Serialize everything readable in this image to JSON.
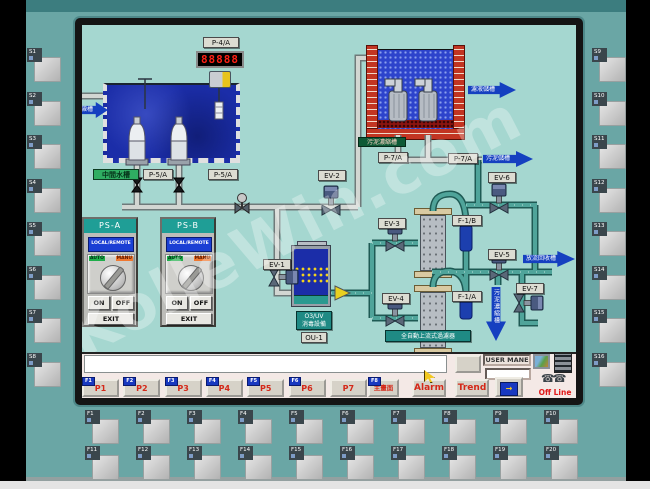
{
  "device": {
    "side_keys_left": [
      "S1",
      "S2",
      "S3",
      "S4",
      "S5",
      "S6",
      "S7",
      "S8"
    ],
    "side_keys_right": [
      "S9",
      "S10",
      "S11",
      "S12",
      "S13",
      "S14",
      "S15",
      "S16"
    ],
    "fn_keys_row1": [
      "F1",
      "F2",
      "F3",
      "F4",
      "F5",
      "F6",
      "F7",
      "F8",
      "F9",
      "F10"
    ],
    "fn_keys_row2": [
      "F11",
      "F12",
      "F13",
      "F14",
      "F15",
      "F16",
      "F17",
      "F18",
      "F19",
      "F20"
    ]
  },
  "watermark": "KolleWin.com",
  "screen": {
    "mimic": {
      "p4a": "P-4/A",
      "flow_display": "88888",
      "mid_tank": "中間水槽",
      "p5a": "P-5/A",
      "p5b": "P-5/A",
      "inlet_arrow": "沉澱槽",
      "filtrate_arrow": "濾液儲槽",
      "sludge_thickener": "污泥濃縮槽",
      "p7a": "P-7/A",
      "p7b": "P-7/A",
      "sludge_arrow": "污泥儲槽",
      "ev1": "EV-1",
      "ev2": "EV-2",
      "ev3": "EV-3",
      "ev4": "EV-4",
      "ev5": "EV-5",
      "ev6": "EV-6",
      "ev7": "EV-7",
      "f1a": "F-1/A",
      "f1b": "F-1/B",
      "discharge_arrow": "放流回收槽",
      "thickener_arrow": "污泥濃縮槽",
      "filter_unit": "全自動上流式過濾器",
      "ou1_line1": "O3/UV",
      "ou1_line2": "消毒設備",
      "ou1": "OU-1"
    },
    "panels": {
      "a": {
        "title": "PS-A"
      },
      "b": {
        "title": "PS-B"
      },
      "local_remote": "LOCAL/REMOTE",
      "auto": "AUTO",
      "manu": "MANU",
      "on": "ON",
      "off": "OFF",
      "exit": "EXIT"
    },
    "toolbar": {
      "page_buttons": [
        {
          "tag": "F1",
          "label": "P1"
        },
        {
          "tag": "F2",
          "label": "P2"
        },
        {
          "tag": "F3",
          "label": "P3"
        },
        {
          "tag": "F4",
          "label": "P4"
        },
        {
          "tag": "F5",
          "label": "P5"
        },
        {
          "tag": "F6",
          "label": "P6"
        },
        {
          "tag": "",
          "label": "P7"
        }
      ],
      "home": {
        "tag": "F8",
        "label": "主畫面"
      },
      "alarm": "Alarm",
      "trend": "Trend",
      "user_label": "USER MANE",
      "user_value": "",
      "offline": "Off Line"
    }
  },
  "colors": {
    "panel_teal": "#6aa6a5",
    "screen_bg": "#a5d7d0",
    "arrow_blue": "#1540c0",
    "alarm_red": "#d42818",
    "water_dark": "#1b2da8",
    "brick_red": "#c23522",
    "lcd_red": "#ff2015"
  }
}
